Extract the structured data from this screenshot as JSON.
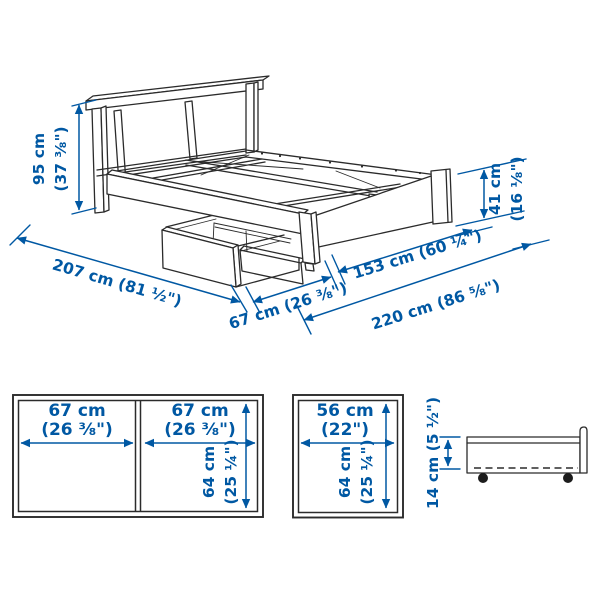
{
  "colors": {
    "accent": "#0058a3",
    "line": "#2b2b2b",
    "background": "#ffffff"
  },
  "main_view": {
    "bed_height_cm": "95 cm",
    "bed_height_in": "(37 ⅜\")",
    "bed_length": "207 cm (81 ½\")",
    "box_pullout": "67 cm (26 ⅜\")",
    "bed_width": "153 cm (60 ¼\")",
    "total_width": "220 cm (86 ⅝\")",
    "footboard_height_cm": "41 cm",
    "footboard_height_in": "(16 ⅛\")"
  },
  "boxes_front_view": {
    "left_width_cm": "67 cm",
    "left_width_in": "(26 ⅜\")",
    "right_width_cm": "67 cm",
    "right_width_in": "(26 ⅜\")",
    "depth_cm": "64 cm",
    "depth_in": "(25 ¼\")"
  },
  "box_front_view_small": {
    "width_cm": "56 cm",
    "width_in": "(22\")",
    "depth_cm": "64 cm",
    "depth_in": "(25 ¼\")"
  },
  "box_side_view": {
    "height": "14 cm (5 ½\")"
  }
}
